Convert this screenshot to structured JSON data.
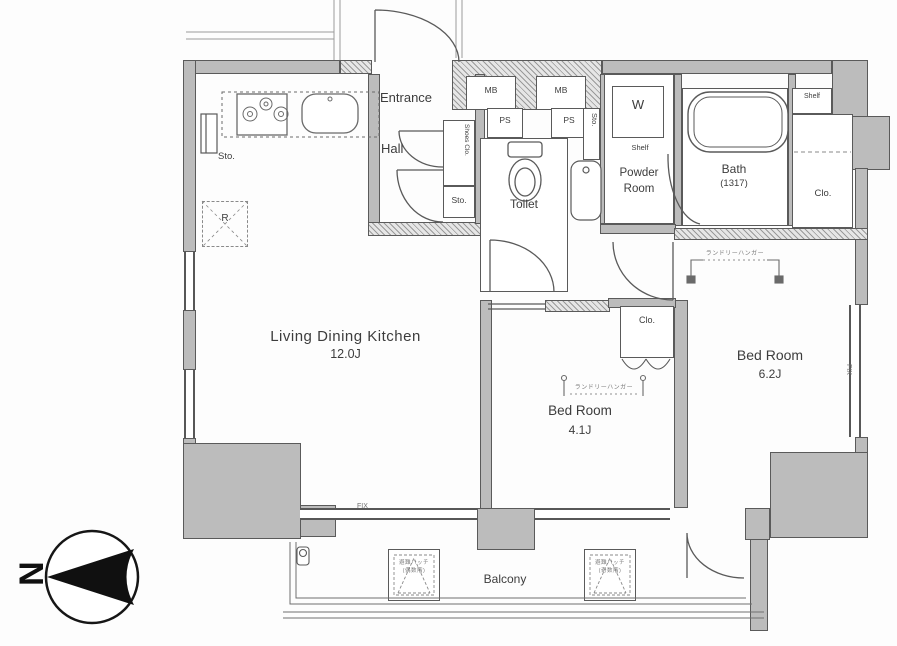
{
  "plan_type": "apartment-floor-plan",
  "rooms": {
    "ldk": {
      "name": "Living Dining Kitchen",
      "size": "12.0J"
    },
    "bedroom_small": {
      "name": "Bed Room",
      "size": "4.1J"
    },
    "bedroom_main": {
      "name": "Bed Room",
      "size": "6.2J"
    }
  },
  "labels": {
    "entrance": "Entrance",
    "hall": "Hall",
    "mb": "MB",
    "ps": "PS",
    "sto": "Sto.",
    "shoes_clo": "Shoes Clo.",
    "toilet": "Toilet",
    "powder_line1": "Powder",
    "powder_line2": "Room",
    "shelf": "Shelf",
    "washer": "W",
    "bath": "Bath",
    "bath_size": "(1317)",
    "clo": "Clo.",
    "fridge": "R",
    "fix": "FIX",
    "balcony": "Balcony",
    "laundry_hanger": "ランドリーハンガー",
    "hatch_title": "避難ハッチ",
    "hatch_sub_left": "(偶数階)",
    "hatch_sub_right": "(奇数階)",
    "north": "N"
  },
  "colors": {
    "wall_fill": "#bcbcbc",
    "line": "#5a5a5a",
    "text": "#3d3d3d",
    "compass": "#101010",
    "background": "#ffffff"
  }
}
